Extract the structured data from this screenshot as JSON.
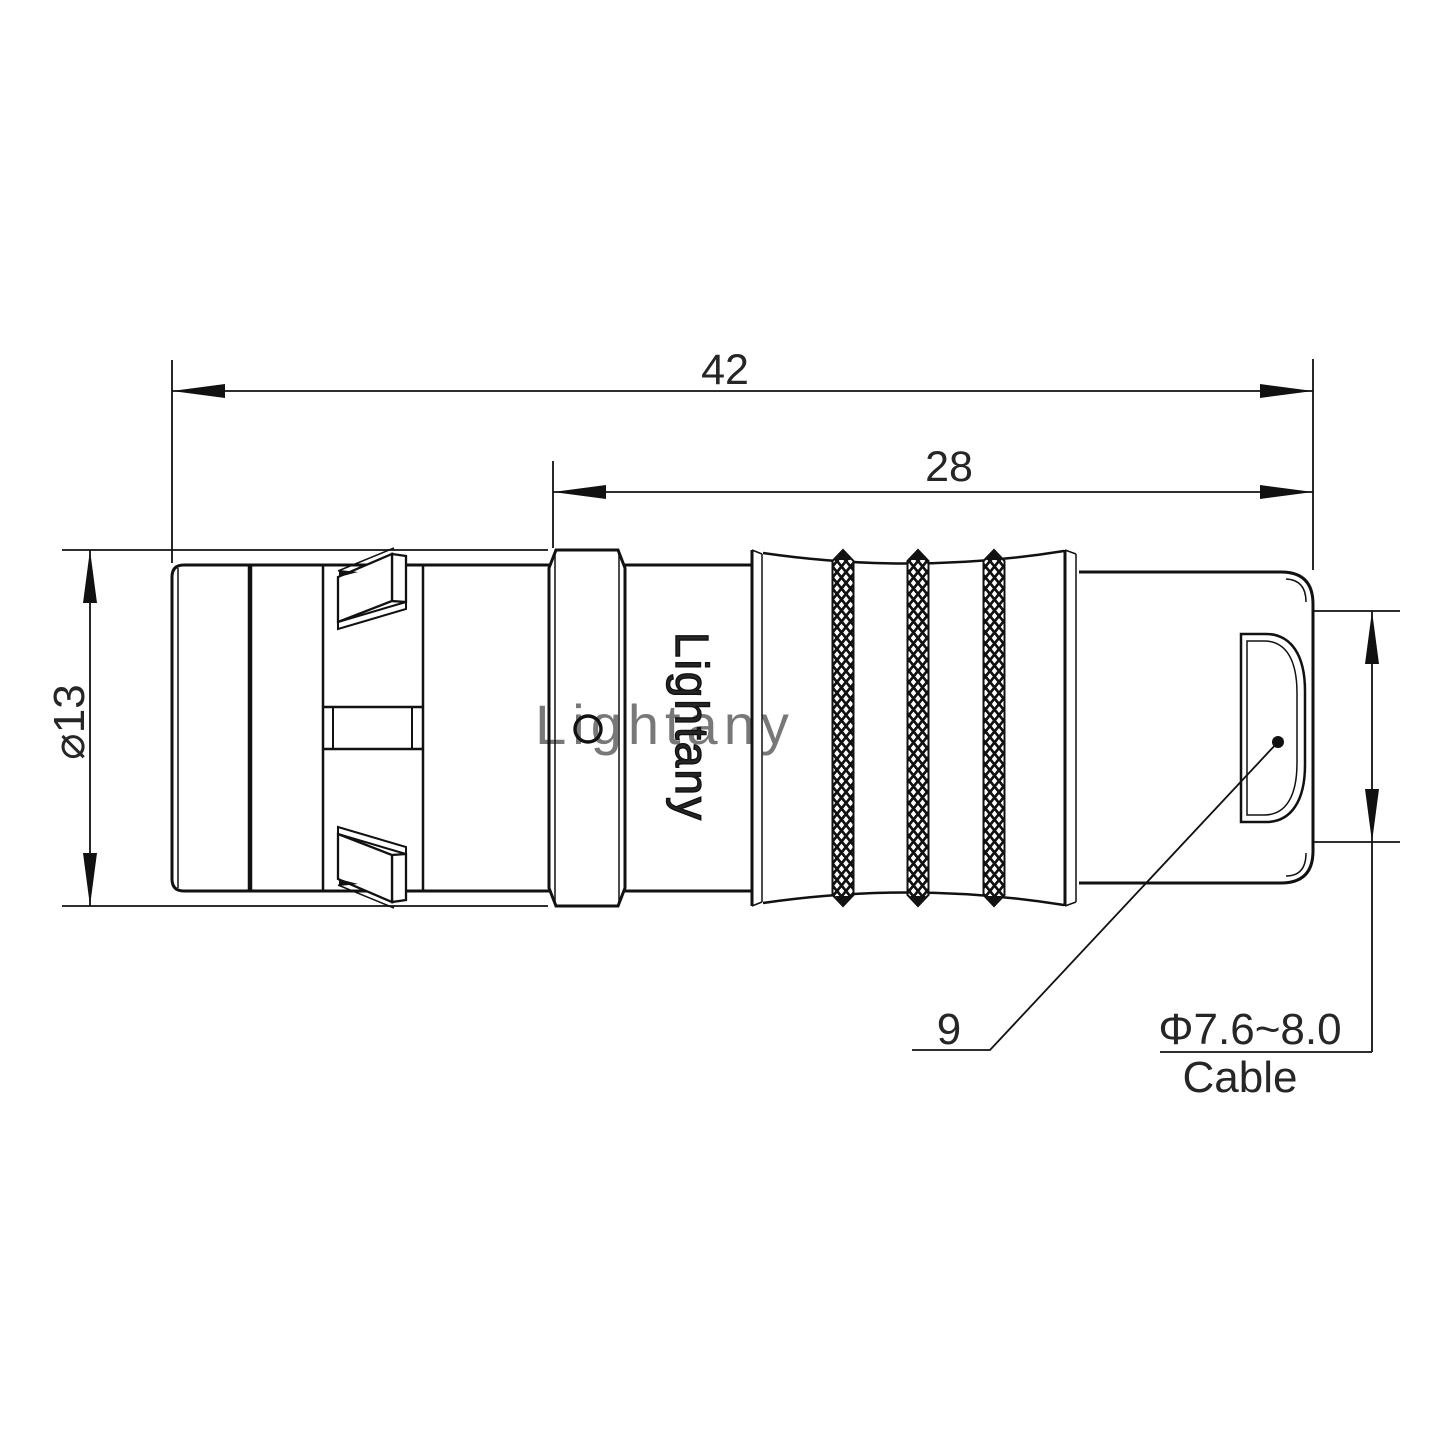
{
  "drawing": {
    "type": "connector-outline-technical-drawing",
    "colors": {
      "background": "#ffffff",
      "line": "#111111",
      "text": "#262626",
      "watermark": "#eaa9ab"
    },
    "dimensions": {
      "overall_length": {
        "label": "42",
        "value": 42
      },
      "rear_length": {
        "label": "28",
        "value": 28
      },
      "body_diameter": {
        "label": "⌀13",
        "value": 13
      },
      "backnut": {
        "label": "9",
        "value": 9
      },
      "cable": {
        "diameter_label": "Φ7.6~8.0",
        "caption": "Cable",
        "min": 7.6,
        "max": 8.0
      }
    },
    "branding": {
      "body_marking": "Lightany",
      "watermark": "Lightany"
    }
  }
}
